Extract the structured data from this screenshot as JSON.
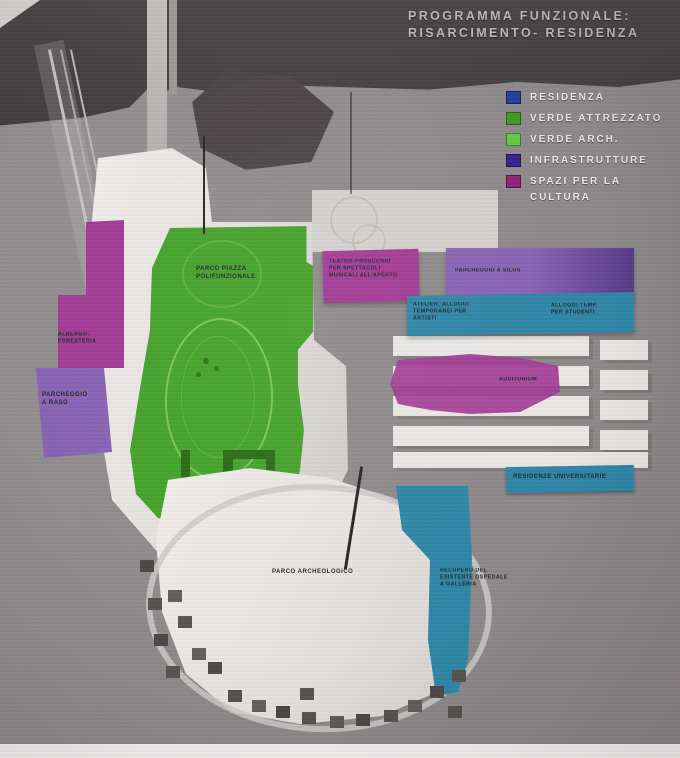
{
  "title": {
    "line1": "PROGRAMMA FUNZIONALE:",
    "line2": "RISARCIMENTO- RESIDENZA"
  },
  "legend": {
    "items": [
      {
        "label": "RESIDENZA",
        "color": "#23409a"
      },
      {
        "label": "VERDE ATTREZZATO",
        "color": "#3f9a2c"
      },
      {
        "label": "VERDE ARCH.",
        "color": "#63c944"
      },
      {
        "label": "INFRASTRUTTURE",
        "color": "#38208c"
      },
      {
        "label": "SPAZI PER LA\nCULTURA",
        "color": "#8f2277"
      }
    ]
  },
  "palette": {
    "cultura_magenta": "#a23b95",
    "parcheggio_purple": "#8a63b5",
    "teal": "#2f86a7",
    "verde_attrezzato": "#45a22a",
    "top_band": "#474244",
    "background_gray": "#918d8f",
    "model_white": "#e8e5e2"
  },
  "map": {
    "zones": [
      {
        "name": "albergo-foresteria",
        "category": "spazi-per-la-cultura",
        "label": "ALBERGO-FORESTERIA"
      },
      {
        "name": "parcheggio-a-raso",
        "category": "infrastrutture",
        "label": "PARCHEGGIO\nA RASO"
      },
      {
        "name": "parco-piazza-polifunzionale",
        "category": "verde-attrezzato",
        "label": "PARCO PIAZZA\nPOLIFUNZIONALE"
      },
      {
        "name": "teatro-proscenio",
        "category": "spazi-per-la-cultura",
        "label": "TEATRO-PROSCENIO\nPER SPETTACOLI\nMUSICALI ALL'APERTO"
      },
      {
        "name": "parcheggio-a-silos",
        "category": "infrastrutture",
        "label": "PARCHEGGIO A SILOS"
      },
      {
        "name": "atelier-alloggi-artisti",
        "category": "residenza",
        "label": "ATELIER, ALLOGGI\nTEMPORANEI PER\nARTISTI"
      },
      {
        "name": "alloggi-studenti",
        "category": "residenza",
        "label": "ALLOGGI TEMP.\nPER STUDENTI"
      },
      {
        "name": "auditorium",
        "category": "spazi-per-la-cultura",
        "label": "AUDITORIUM"
      },
      {
        "name": "residenze-universitarie",
        "category": "residenza",
        "label": "RESIDENZE UNIVERSITARIE"
      },
      {
        "name": "recupero-ospedale",
        "category": "residenza",
        "label": "RECUPERO DEL\nESISTENTE OSPEDALE\nA GALLERIA"
      },
      {
        "name": "parco-archeologico",
        "category": "verde-arch",
        "label": "PARCO ARCHEOLOGICO"
      }
    ]
  }
}
